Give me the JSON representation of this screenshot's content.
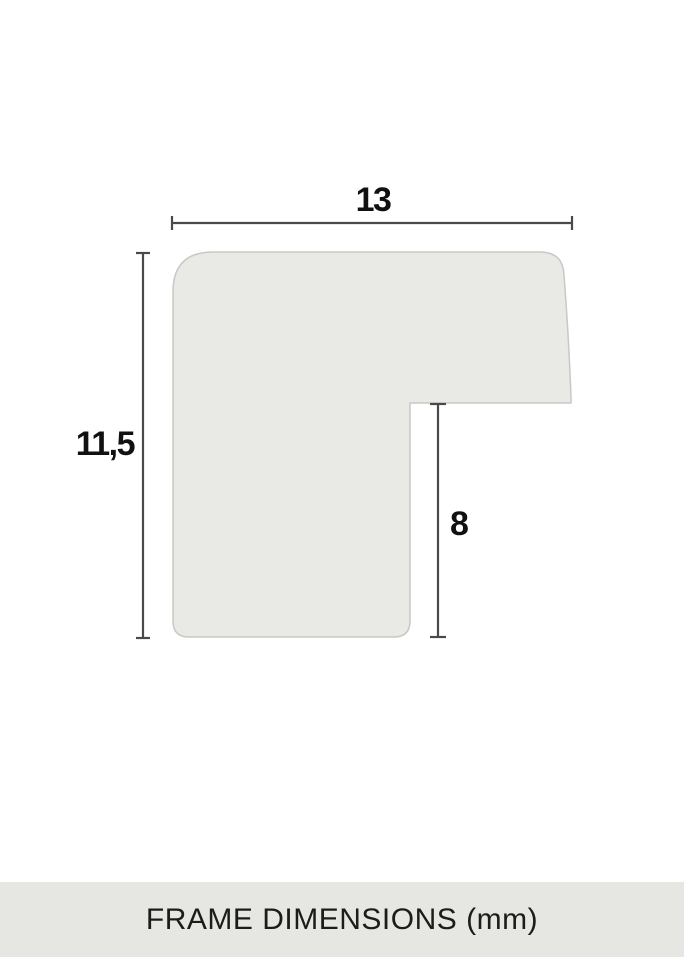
{
  "diagram": {
    "caption": "FRAME DIMENSIONS (mm)",
    "dimensions": {
      "width": "13",
      "height": "11,5",
      "inner_depth": "8"
    }
  },
  "colors": {
    "background": "#ffffff",
    "profile_fill": "#e9e9e5",
    "profile_stroke": "#c8c8c4",
    "dimension_line": "#4a4a4a",
    "label_text": "#111111",
    "caption_bar_background": "#e6e6e2",
    "caption_text": "#1c1c1a"
  }
}
